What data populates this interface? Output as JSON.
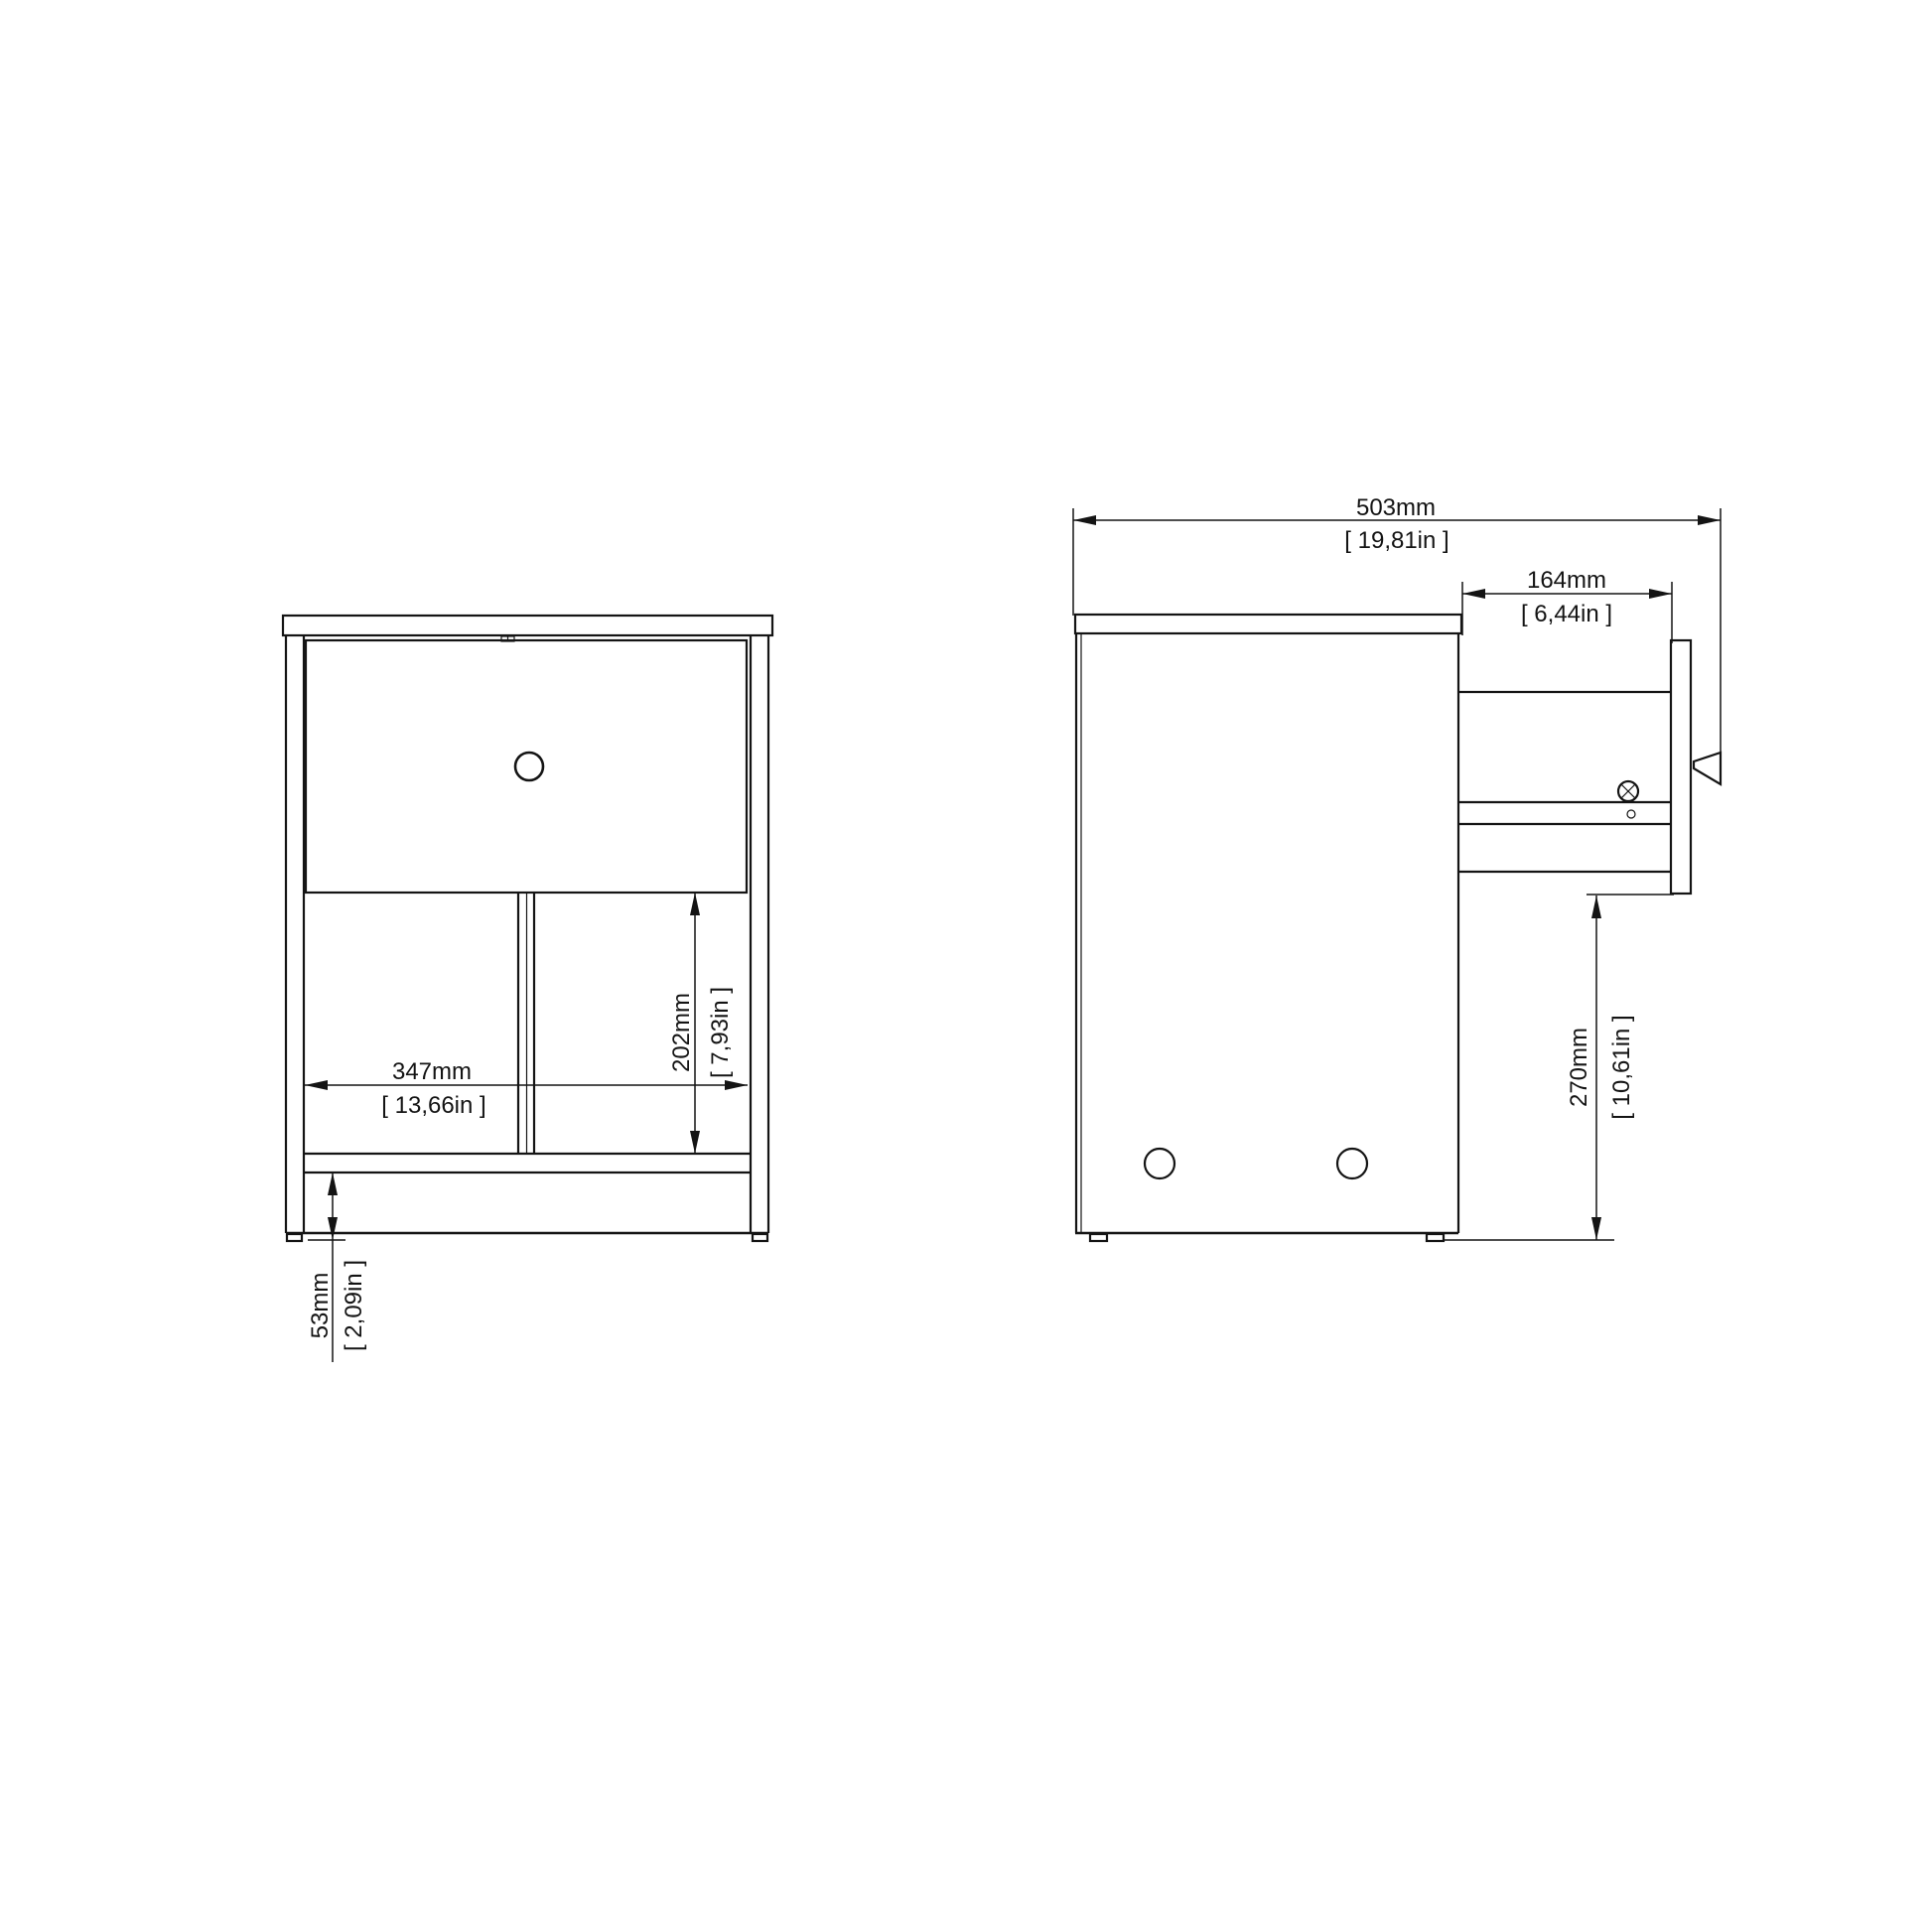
{
  "colors": {
    "background": "#ffffff",
    "ink": "#141414"
  },
  "front_view": {
    "dim_inner_width": {
      "mm": "347mm",
      "inch": "[ 13,66in ]"
    },
    "dim_shelf_height": {
      "mm": "202mm",
      "inch": "[ 7,93in ]"
    },
    "dim_base_height": {
      "mm": "53mm",
      "inch": "[ 2,09in ]"
    }
  },
  "side_view": {
    "dim_total_depth": {
      "mm": "503mm",
      "inch": "[ 19,81in ]"
    },
    "dim_drawer_extension": {
      "mm": "164mm",
      "inch": "[ 6,44in ]"
    },
    "dim_clearance_height": {
      "mm": "270mm",
      "inch": "[ 10,61in ]"
    }
  }
}
